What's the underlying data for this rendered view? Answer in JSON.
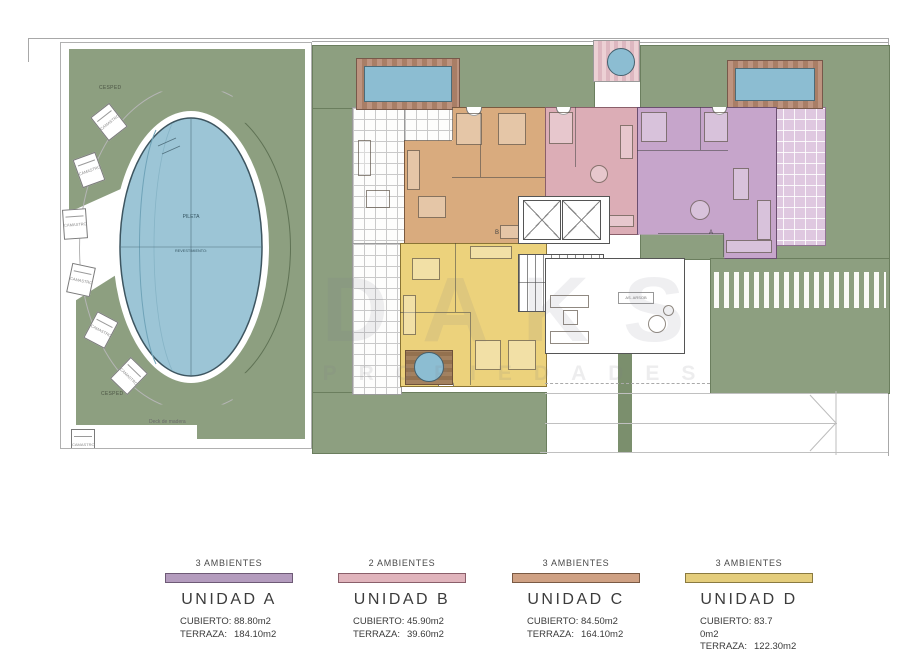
{
  "watermark": {
    "line1": "DAKS",
    "line2": "PROPIEDADES"
  },
  "garden": {
    "grass_label_top": "CESPED",
    "grass_label_bottom": "CESPED",
    "pool_label": "PILETA",
    "pool_sublabel": "REVESTIMIENTO:",
    "chair_label": "CAMASTRO",
    "deck_label": "Deck de madera"
  },
  "building": {
    "lobby_tag": "AS. ARSOB",
    "section_marker_a": "A",
    "section_marker_b": "B"
  },
  "legend": {
    "items": [
      {
        "ambientes": "3 AMBIENTES",
        "name": "UNIDAD A",
        "bar_color": "#b49cbe",
        "bar_border": "#6e5a76",
        "rows": [
          {
            "l": "CUBIERTO:",
            "v": "88.80m2"
          },
          {
            "l": "TERRAZA:",
            "v": "184.10m2"
          }
        ]
      },
      {
        "ambientes": "2 AMBIENTES",
        "name": "UNIDAD B",
        "bar_color": "#e0b4bc",
        "bar_border": "#8a5f6a",
        "rows": [
          {
            "l": "CUBIERTO:",
            "v": "45.90m2"
          },
          {
            "l": "TERRAZA:",
            "v": "39.60m2"
          }
        ]
      },
      {
        "ambientes": "3 AMBIENTES",
        "name": "UNIDAD C",
        "bar_color": "#cfa184",
        "bar_border": "#7a5a44",
        "rows": [
          {
            "l": "CUBIERTO:",
            "v": "84.50m2"
          },
          {
            "l": "TERRAZA:",
            "v": "164.10m2"
          }
        ]
      },
      {
        "ambientes": "3 AMBIENTES",
        "name": "UNIDAD D",
        "bar_color": "#e4cd7c",
        "bar_border": "#8a7a40",
        "rows": [
          {
            "l": "CUBIERTO:",
            "v": "83.7"
          },
          {
            "l": "0m2",
            "v": ""
          },
          {
            "l": "TERRAZA:",
            "v": "122.30m2"
          }
        ]
      }
    ]
  },
  "colors": {
    "grass": "#8d9f80",
    "water": "#9cc5d6",
    "unit_a": "#c6a5cb",
    "unit_b": "#dcadb6",
    "unit_c": "#d9ab7e",
    "unit_d": "#ecd27c"
  }
}
